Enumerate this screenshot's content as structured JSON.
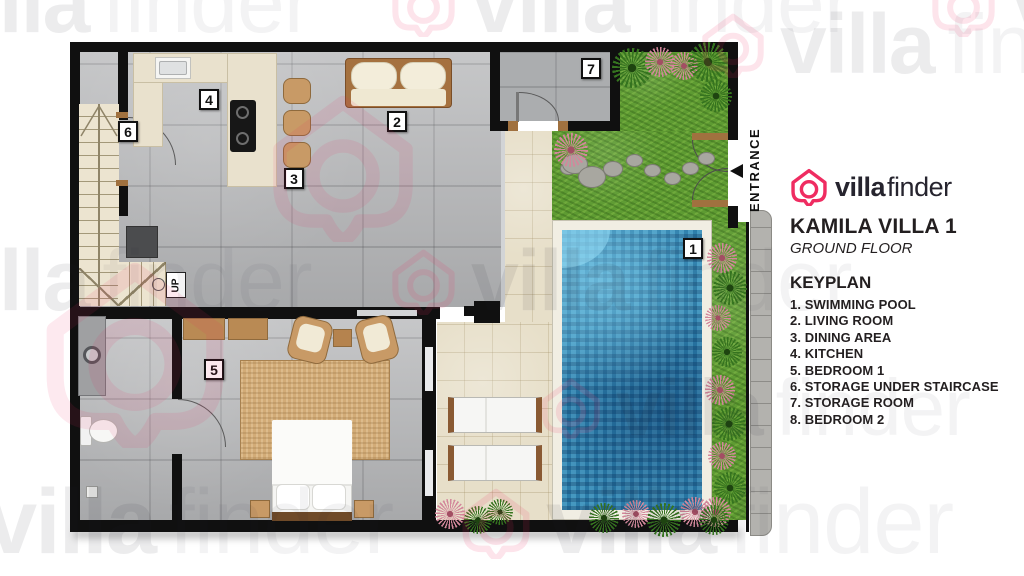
{
  "brand": {
    "logo_bold": "villa",
    "logo_light": "finder",
    "pink": "#ef2c61"
  },
  "panel": {
    "title": "KAMILA VILLA 1",
    "subtitle": "GROUND FLOOR",
    "keyplan_title": "KEYPLAN",
    "keyplan_items": [
      "1. SWIMMING POOL",
      "2. LIVING ROOM",
      "3. DINING AREA",
      "4. KITCHEN",
      "5. BEDROOM 1",
      "6. STORAGE UNDER STAIRCASE",
      "7. STORAGE ROOM",
      "8. BEDROOM 2"
    ]
  },
  "plan": {
    "entrance_label": "ENTRANCE",
    "up_label": "UP",
    "markers": [
      {
        "num": "1",
        "label": "SWIMMING POOL",
        "x": 683,
        "y": 238
      },
      {
        "num": "2",
        "label": "LIVING ROOM",
        "x": 387,
        "y": 111
      },
      {
        "num": "3",
        "label": "DINING AREA",
        "x": 284,
        "y": 168
      },
      {
        "num": "4",
        "label": "KITCHEN",
        "x": 199,
        "y": 89
      },
      {
        "num": "5",
        "label": "BEDROOM 1",
        "x": 204,
        "y": 359
      },
      {
        "num": "6",
        "label": "STORAGE UNDER STAIRCASE",
        "x": 118,
        "y": 121
      },
      {
        "num": "7",
        "label": "STORAGE ROOM",
        "x": 581,
        "y": 58
      }
    ]
  },
  "watermark": {
    "bold": "villa",
    "light": "finder"
  }
}
